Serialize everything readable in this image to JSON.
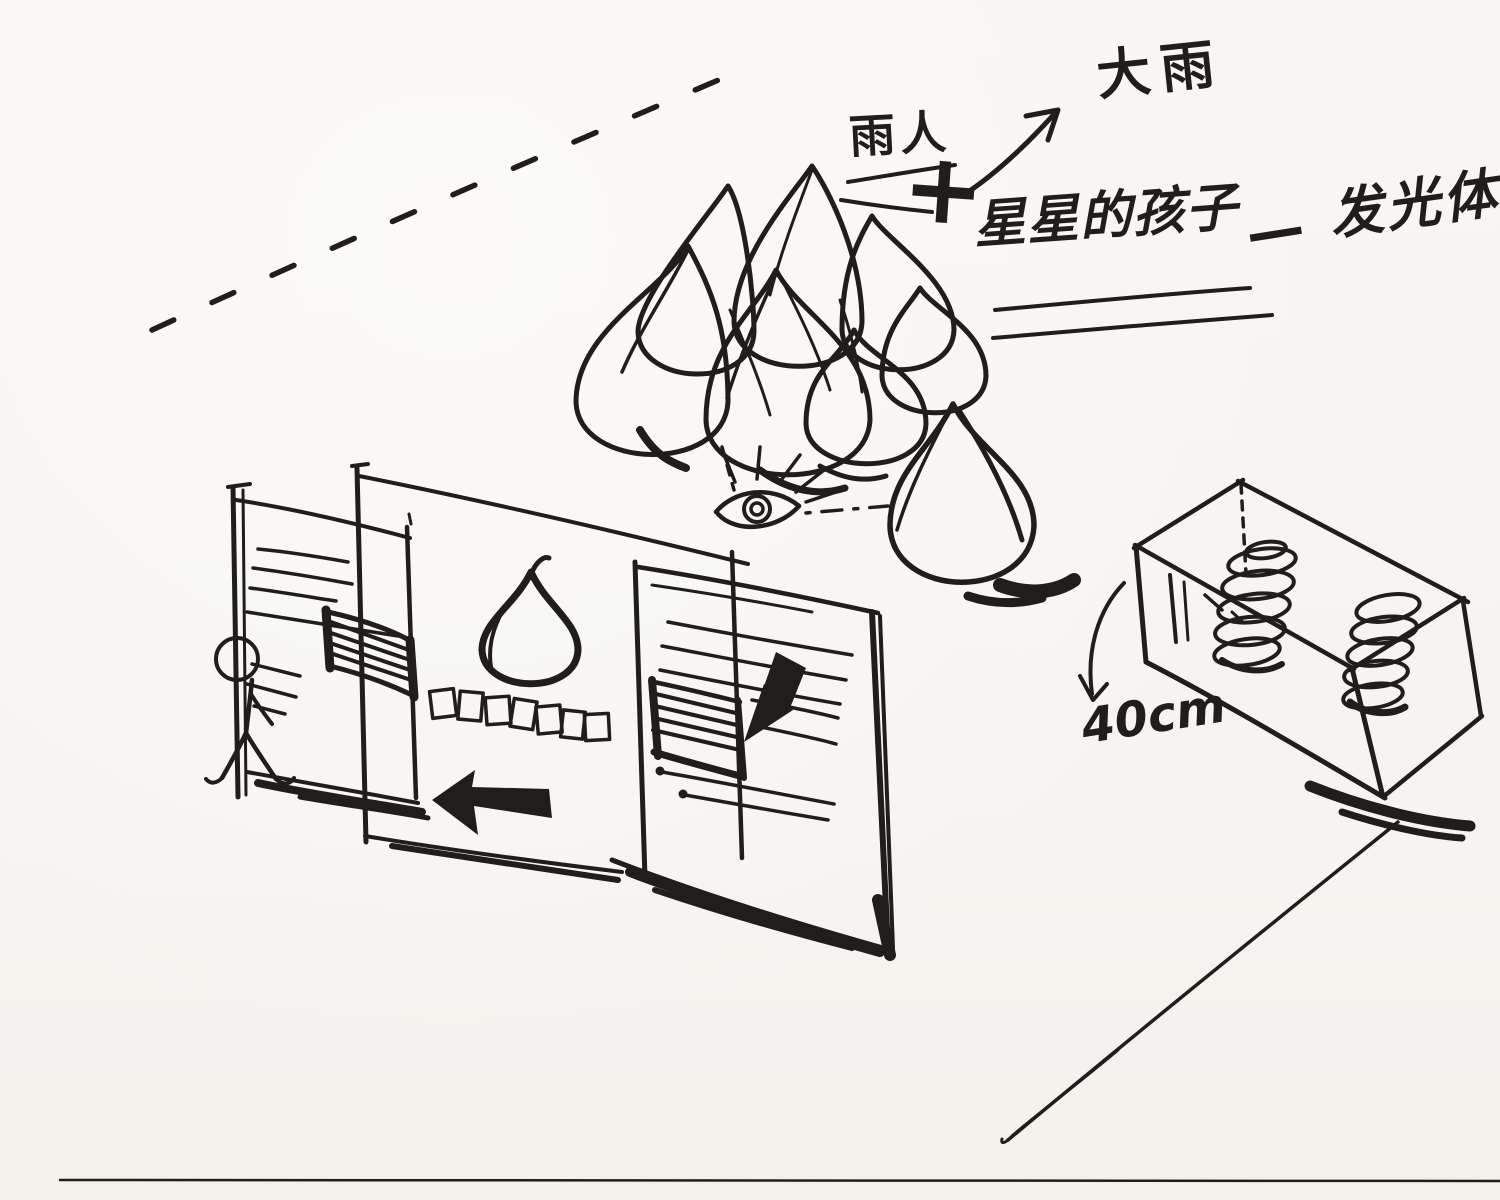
{
  "scene": {
    "kind": "hand-drawn installation concept sketch, black ink on white paper",
    "paper_color": "#f7f5f1",
    "ink_color": "#201d1a"
  },
  "labels": {
    "rain_person": "雨人",
    "heavy_rain": "大雨",
    "plus": "+",
    "star_children": "星星的孩子",
    "dash": "—",
    "glow_body": "发光体",
    "box_height": "40cm"
  },
  "elements": [
    {
      "name": "dashed-perspective-line",
      "desc": "long dashed diagonal line, upper left"
    },
    {
      "name": "annotation-arrow",
      "desc": "hand arrow from 雨人 pointing to 大雨"
    },
    {
      "name": "underline-rain-person",
      "desc": "double underline under 雨人"
    },
    {
      "name": "underline-star-children",
      "desc": "double underline under 星星的孩子"
    },
    {
      "name": "droplet-cluster",
      "desc": "cluster of seven sketched water drops"
    },
    {
      "name": "single-droplet",
      "desc": "separate water drop with cast shadow, lower right of cluster"
    },
    {
      "name": "observer-eye",
      "desc": "eye with lashes, dashed sight lines to the drops"
    },
    {
      "name": "exhibit-panel-left",
      "desc": "standing panel with text lines and hatched block"
    },
    {
      "name": "exhibit-panel-middle",
      "desc": "wide panel with drop pictogram and row of small squares"
    },
    {
      "name": "exhibit-panel-right",
      "desc": "standing panel with text lines, hatched block and cursor arrow"
    },
    {
      "name": "left-arrow",
      "desc": "solid arrow pointing left under middle panel"
    },
    {
      "name": "cursor-arrow",
      "desc": "solid arrow pointing down-left on right panel"
    },
    {
      "name": "stick-figure",
      "desc": "walking visitor at far left"
    },
    {
      "name": "spring-platform",
      "desc": "low box platform with two coil springs on top"
    },
    {
      "name": "height-arrow",
      "desc": "curved arrow marking 40cm height of platform"
    },
    {
      "name": "floor-diagonal",
      "desc": "long diagonal floor line, bottom right"
    }
  ]
}
